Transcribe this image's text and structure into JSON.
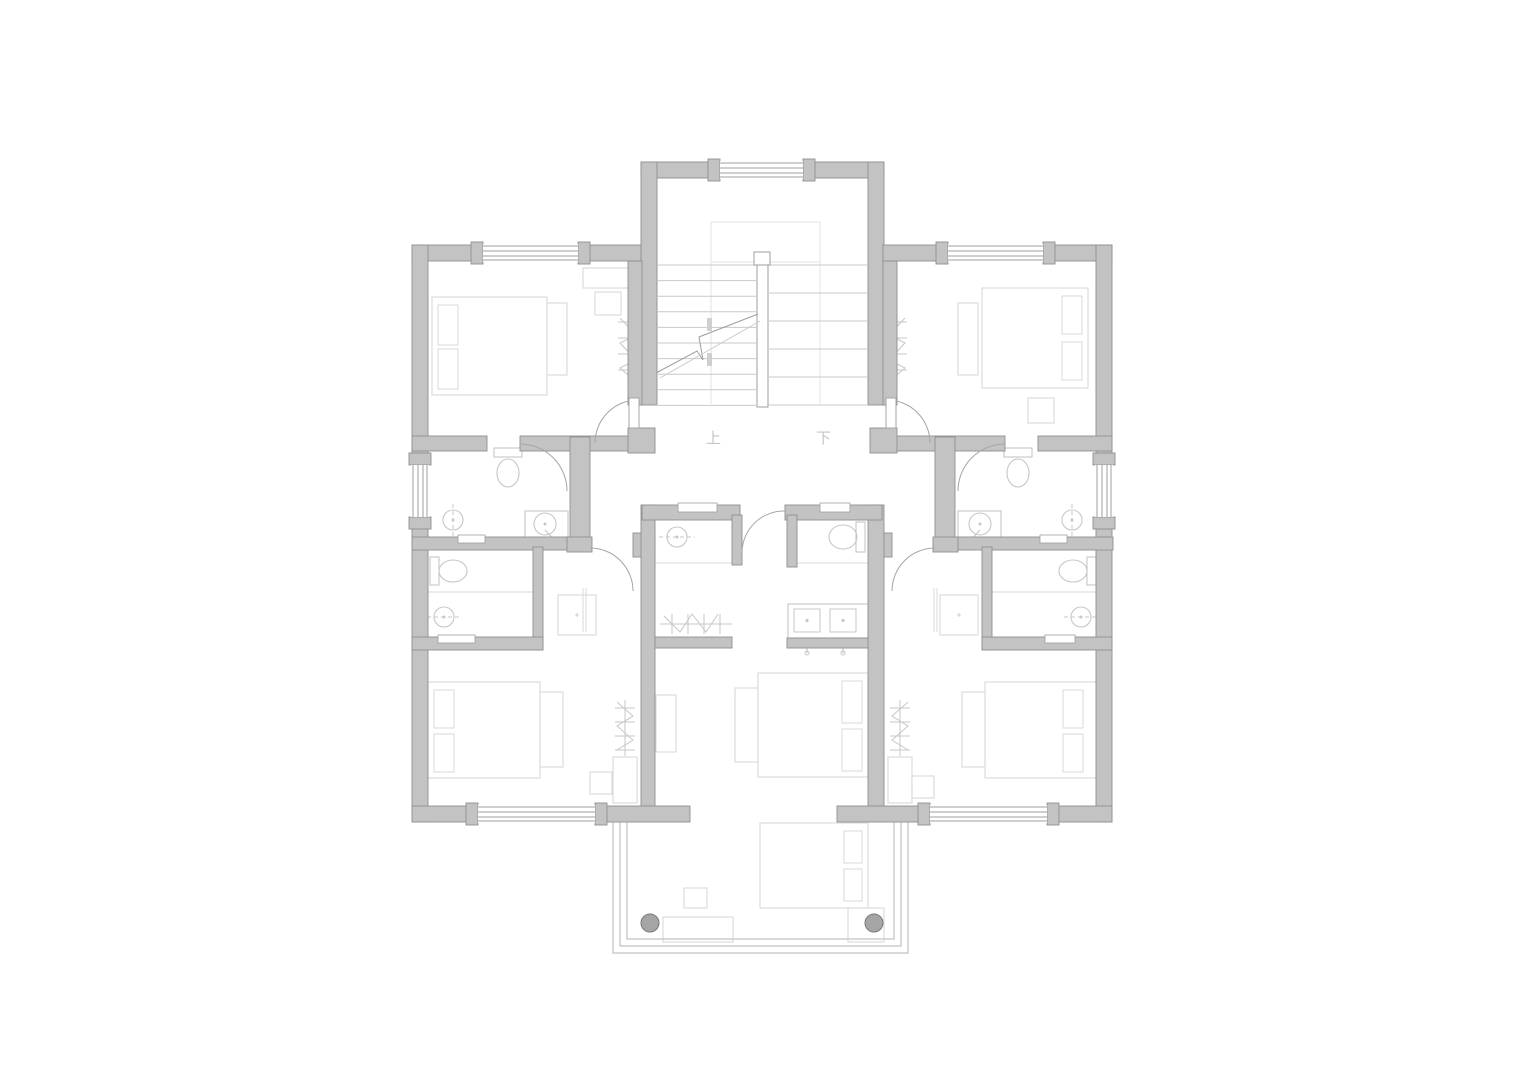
{
  "title": "second-floor-plan",
  "canvas": {
    "width": 1536,
    "height": 1086
  },
  "colors": {
    "background": "#ffffff",
    "wall_fill": "#c3c3c3",
    "wall_stroke": "#8f8f8f",
    "window_line": "#9f9f9f",
    "door_arc": "#a5a5a5",
    "stair_line": "#c9c9c9",
    "stair_faint": "#e3e3e3",
    "break_tick": "#cfcfcf",
    "furniture_line": "#d9d9d9",
    "fixture_line": "#c7c7c7",
    "railing_line": "#c2c2c2",
    "column_fill": "#a5a5a5",
    "column_stroke": "#7a7a7a",
    "label_color": "#c6c6c6"
  },
  "labels": [
    {
      "text": "上",
      "x": 706,
      "y": 443,
      "size": 15
    },
    {
      "text": "下",
      "x": 816,
      "y": 443,
      "size": 15
    }
  ],
  "walls": [
    [
      641,
      162,
      79,
      16
    ],
    [
      803,
      162,
      81,
      16
    ],
    [
      641,
      162,
      16,
      243
    ],
    [
      868,
      162,
      16,
      243
    ],
    [
      412,
      245,
      71,
      16
    ],
    [
      578,
      245,
      63,
      16
    ],
    [
      883,
      245,
      65,
      16
    ],
    [
      1043,
      245,
      69,
      16
    ],
    [
      412,
      245,
      16,
      577
    ],
    [
      1096,
      245,
      16,
      577
    ],
    [
      628,
      261,
      14,
      144
    ],
    [
      883,
      261,
      14,
      144
    ],
    [
      412,
      436,
      75,
      15
    ],
    [
      520,
      436,
      122,
      15
    ],
    [
      883,
      436,
      122,
      15
    ],
    [
      1038,
      436,
      74,
      15
    ],
    [
      628,
      428,
      27,
      25
    ],
    [
      870,
      428,
      27,
      25
    ],
    [
      570,
      437,
      20,
      113
    ],
    [
      935,
      437,
      20,
      113
    ],
    [
      412,
      537,
      158,
      13
    ],
    [
      955,
      537,
      158,
      13
    ],
    [
      567,
      537,
      25,
      15
    ],
    [
      933,
      537,
      25,
      15
    ],
    [
      633,
      533,
      22,
      24
    ],
    [
      870,
      533,
      22,
      24
    ],
    [
      533,
      547,
      10,
      103
    ],
    [
      982,
      547,
      10,
      103
    ],
    [
      412,
      637,
      131,
      13
    ],
    [
      982,
      637,
      130,
      13
    ],
    [
      641,
      505,
      14,
      301
    ],
    [
      868,
      505,
      16,
      301
    ],
    [
      642,
      505,
      98,
      15
    ],
    [
      785,
      505,
      97,
      15
    ],
    [
      732,
      515,
      10,
      50
    ],
    [
      787,
      515,
      10,
      52
    ],
    [
      655,
      637,
      77,
      11
    ],
    [
      787,
      638,
      81,
      10
    ],
    [
      412,
      806,
      66,
      16
    ],
    [
      595,
      806,
      95,
      16
    ],
    [
      837,
      806,
      93,
      16
    ],
    [
      1047,
      806,
      65,
      16
    ]
  ],
  "windows": [
    {
      "rect": [
        720,
        162,
        83,
        16
      ],
      "orient": "h"
    },
    {
      "rect": [
        483,
        245,
        95,
        16
      ],
      "orient": "h"
    },
    {
      "rect": [
        948,
        245,
        95,
        16
      ],
      "orient": "h"
    },
    {
      "rect": [
        412,
        465,
        16,
        52
      ],
      "orient": "v"
    },
    {
      "rect": [
        1096,
        465,
        16,
        52
      ],
      "orient": "v"
    },
    {
      "rect": [
        478,
        806,
        117,
        16
      ],
      "orient": "h"
    },
    {
      "rect": [
        930,
        806,
        117,
        16
      ],
      "orient": "h"
    }
  ],
  "notches": [
    [
      678,
      503,
      39,
      9
    ],
    [
      820,
      503,
      30,
      9
    ],
    [
      458,
      535,
      27,
      8
    ],
    [
      1040,
      535,
      27,
      8
    ],
    [
      438,
      635,
      37,
      8
    ],
    [
      1045,
      635,
      30,
      8
    ]
  ],
  "door_arcs": [
    "M 595,443 A 43,43 0 0 1 638,400",
    "M 930,443 A 43,43 0 0 0 887,400",
    "M 520,444 A 47,47 0 0 1 567,491",
    "M 1005,444 A 47,47 0 0 0 958,491",
    "M 590,548 A 43,43 0 0 1 633,591",
    "M 935,548 A 43,43 0 0 0 892,591",
    "M 742,553 A 42,42 0 0 1 785,511"
  ],
  "door_leaves": [
    [
      629,
      398,
      10,
      30
    ],
    [
      886,
      398,
      10,
      30
    ]
  ],
  "stairs": {
    "left_treads": {
      "x1": 658,
      "x2": 756,
      "y0": 265,
      "step": 15.6,
      "count": 10
    },
    "right_treads": {
      "x1": 769,
      "x2": 867,
      "y0": 265,
      "step": 28,
      "count": 6
    },
    "rail": [
      757,
      255,
      11,
      152
    ],
    "rail_cap": [
      754,
      252,
      16,
      13
    ],
    "landing": [
      711,
      222,
      109,
      40
    ],
    "guides": [
      [
        711,
        262,
        711,
        404
      ],
      [
        820,
        262,
        820,
        404
      ]
    ],
    "break_main": "M656,373 L697,351 L703,360 L699,337 L758,314",
    "break_second": "M660,378 L760,321",
    "break_ticks": [
      [
        707,
        318,
        5,
        13
      ],
      [
        707,
        353,
        5,
        13
      ]
    ]
  },
  "fixtures": {
    "toilets": [
      {
        "tank": [
          494,
          448,
          28,
          9
        ],
        "bowl": [
          508,
          473,
          11,
          14
        ]
      },
      {
        "tank": [
          1004,
          448,
          28,
          9
        ],
        "bowl": [
          1018,
          473,
          11,
          14
        ]
      },
      {
        "tank": [
          430,
          557,
          9,
          28
        ],
        "bowl": [
          453,
          571,
          14,
          11
        ]
      },
      {
        "tank": [
          1087,
          557,
          9,
          28
        ],
        "bowl": [
          1073,
          571,
          14,
          11
        ]
      },
      {
        "tank": [
          856,
          522,
          9,
          30
        ],
        "bowl": [
          843,
          537,
          14,
          12
        ]
      }
    ],
    "sinks": [
      {
        "counter": [
          525,
          511,
          43,
          27
        ],
        "c": [
          545,
          524
        ],
        "r": 11,
        "tap": [
          545,
          530,
          556,
          542
        ]
      },
      {
        "counter": [
          958,
          511,
          43,
          27
        ],
        "c": [
          980,
          524
        ],
        "r": 11,
        "tap": [
          980,
          530,
          969,
          542
        ]
      }
    ],
    "showers": [
      {
        "c": [
          453,
          520
        ],
        "r": 10,
        "dash": [
          453,
          504,
          453,
          542
        ]
      },
      {
        "c": [
          1072,
          520
        ],
        "r": 10,
        "dash": [
          1072,
          504,
          1072,
          542
        ]
      },
      {
        "c": [
          444,
          617
        ],
        "r": 10,
        "dash": [
          427,
          617,
          461,
          617
        ]
      },
      {
        "c": [
          1081,
          617
        ],
        "r": 10,
        "dash": [
          1064,
          617,
          1098,
          617
        ]
      },
      {
        "c": [
          677,
          537
        ],
        "r": 10,
        "dash": [
          659,
          537,
          695,
          537
        ]
      }
    ],
    "double_vanity": {
      "rect": [
        788,
        604,
        80,
        34
      ],
      "basins": [
        [
          794,
          609,
          26,
          23
        ],
        [
          830,
          609,
          26,
          23
        ]
      ],
      "taps": [
        [
          807,
          640,
          807,
          653
        ],
        [
          843,
          640,
          843,
          653
        ]
      ]
    },
    "light_lines": [
      [
        428,
        592,
        533,
        592
      ],
      [
        992,
        592,
        1097,
        592
      ],
      [
        655,
        563,
        732,
        563
      ],
      [
        787,
        563,
        868,
        563
      ]
    ]
  },
  "furniture": {
    "beds": [
      {
        "r": [
          432,
          297,
          115,
          98
        ],
        "p": [
          [
            438,
            305,
            20,
            40
          ],
          [
            438,
            349,
            20,
            40
          ]
        ]
      },
      {
        "r": [
          982,
          288,
          106,
          100
        ],
        "p": [
          [
            1062,
            296,
            20,
            38
          ],
          [
            1062,
            342,
            20,
            38
          ]
        ]
      },
      {
        "r": [
          428,
          682,
          112,
          96
        ],
        "p": [
          [
            434,
            690,
            20,
            38
          ],
          [
            434,
            734,
            20,
            38
          ]
        ]
      },
      {
        "r": [
          985,
          682,
          112,
          96
        ],
        "p": [
          [
            1063,
            690,
            20,
            38
          ],
          [
            1063,
            734,
            20,
            38
          ]
        ]
      },
      {
        "r": [
          758,
          673,
          110,
          104
        ],
        "p": [
          [
            842,
            681,
            20,
            42
          ],
          [
            842,
            729,
            20,
            42
          ]
        ]
      },
      {
        "r": [
          760,
          823,
          108,
          85
        ],
        "p": [
          [
            844,
            831,
            18,
            32
          ],
          [
            844,
            869,
            18,
            32
          ]
        ]
      }
    ],
    "rects": [
      [
        547,
        303,
        20,
        72
      ],
      [
        958,
        303,
        20,
        72
      ],
      [
        540,
        692,
        23,
        75
      ],
      [
        962,
        692,
        23,
        75
      ],
      [
        735,
        688,
        23,
        74
      ],
      [
        583,
        268,
        54,
        20
      ],
      [
        595,
        292,
        26,
        23
      ],
      [
        1028,
        398,
        26,
        25
      ],
      [
        590,
        772,
        22,
        22
      ],
      [
        912,
        776,
        22,
        22
      ],
      [
        656,
        695,
        20,
        57
      ],
      [
        613,
        757,
        24,
        46
      ],
      [
        888,
        757,
        24,
        46
      ],
      [
        848,
        908,
        36,
        34
      ],
      [
        663,
        917,
        70,
        25
      ],
      [
        684,
        888,
        23,
        20
      ]
    ],
    "vanities": [
      {
        "r": [
          558,
          595,
          38,
          40
        ],
        "dot": [
          577,
          615
        ],
        "lines": [
          [
            583,
            588,
            583,
            632
          ],
          [
            586,
            588,
            586,
            632
          ]
        ]
      },
      {
        "r": [
          940,
          595,
          38,
          40
        ],
        "dot": [
          959,
          615
        ],
        "lines": [
          [
            937,
            588,
            937,
            632
          ],
          [
            934,
            588,
            934,
            632
          ]
        ]
      }
    ],
    "zigzags": [
      "M628,316 L628,384 M618,322 H638 M618,338 H638 M618,354 H638 M618,370 H638 M620,318 L636,335 L620,343 L636,360 L620,368 L636,382",
      "M897,316 L897,384 M887,322 H907 M887,338 H907 M887,354 H907 M887,370 H907 M905,318 L889,335 L905,343 L889,360 L905,368 L889,382",
      "M625,700 L625,756 M615,708 H635 M615,722 H635 M615,736 H635 M615,750 H635 M617,702 L633,716 L617,726 L633,740 L617,750",
      "M900,700 L900,756 M890,708 H910 M890,722 H910 M890,736 H910 M890,750 H910 M908,702 L892,716 L908,726 L892,740 L908,750",
      "M660,624 H732 M672,614 V634 M688,614 V634 M704,614 V634 M720,614 V634 M664,616 L680,632 L692,614 L706,632 L718,614"
    ]
  },
  "balcony": {
    "rails": [
      "M613,822 V953 H908 V822",
      "M620,822 V946 H901 V822",
      "M627,822 V939 H894 V822"
    ],
    "columns": [
      [
        650,
        923,
        9
      ],
      [
        874,
        923,
        9
      ]
    ]
  }
}
